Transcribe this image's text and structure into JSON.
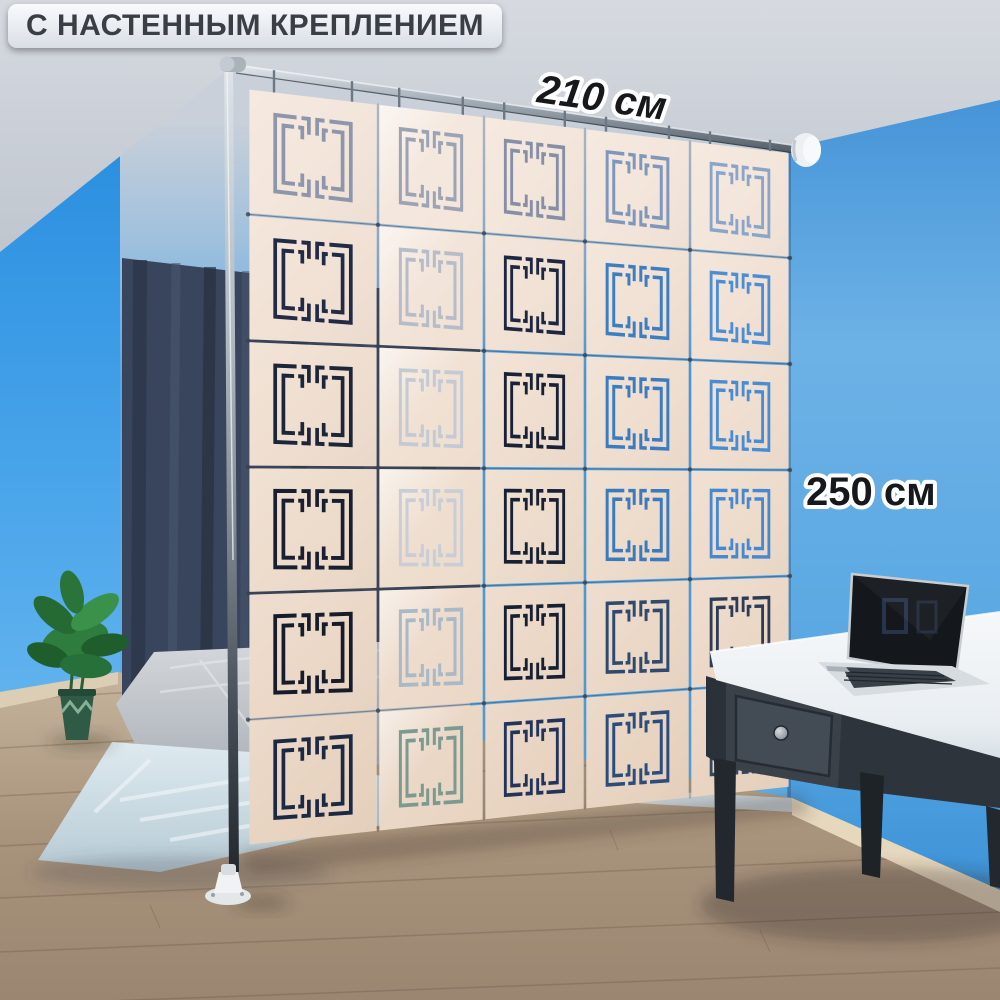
{
  "banner": {
    "label": "С НАСТЕННЫМ КРЕПЛЕНИЕМ",
    "bg": "#eef1f5",
    "text_color": "#3a3f46"
  },
  "dimensions": {
    "width_label": "210 см",
    "height_label": "250 см",
    "text_color": "#16181c",
    "outline_color": "#ffffff"
  },
  "divider": {
    "rows": 6,
    "cols": 5,
    "panel_row_colors": [
      "#f3e5da",
      "#f1e1d4",
      "#efdecf",
      "#eddbca",
      "#ebd7c6",
      "#e8d3c0"
    ],
    "glyph_colors": [
      [
        "#8e96ab",
        "#9ba3b4",
        "#868fa6",
        "#7f97bb",
        "#8aa5c8"
      ],
      [
        "#222b45",
        "#b6bdc9",
        "#1d2741",
        "#3c7ec2",
        "#4a8ed6"
      ],
      [
        "#1d2539",
        "#c4cad3",
        "#192235",
        "#3a7cc0",
        "#488cd4"
      ],
      [
        "#191f30",
        "#c9ced6",
        "#182134",
        "#3a7abd",
        "#4789d0"
      ],
      [
        "#161c2a",
        "#a9b9c6",
        "#172031",
        "#2e4a6d",
        "#2d3b55"
      ],
      [
        "#1c2944",
        "#7d9a90",
        "#223459",
        "#2c4d7c",
        "#344763"
      ]
    ],
    "seam_color": "#3c4350",
    "hook_color": "#6d7884",
    "connector_color": "#39414e"
  },
  "hardware": {
    "pole_color": "#8a929b",
    "rod_color": "#9aa3ad",
    "bracket_color": "#eef1f4",
    "flange_color": "#eff1f3"
  },
  "room": {
    "left_wall": "#3b9ce6",
    "back_wall": "#56a8e6",
    "right_wall": "#63aee6",
    "ceiling": "#ccd1d8",
    "floor": "#ab967f",
    "baseboard": "#dfd0b5",
    "curtain": "#39455c",
    "mattress": "#bfc3c8",
    "blanket": "#c9dae2",
    "plant_leaf": "#2e7d3e",
    "plant_pot": "#2f5b46"
  },
  "furniture": {
    "desk_top": "#f2f5f7",
    "desk_body": "#3a4149",
    "laptop_body": "#d7dce0",
    "laptop_screen": "#14171c"
  }
}
